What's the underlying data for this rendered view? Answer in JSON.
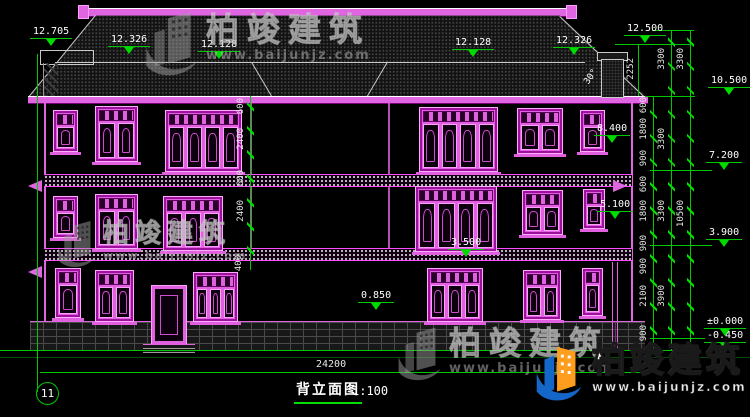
{
  "drawing": {
    "axis_bubble": "11",
    "title": "背立面图",
    "scale": "1:100",
    "total_width_dim": "24200",
    "roof_angle": "30°",
    "chimney_height_dim": "2252"
  },
  "watermark": {
    "brand": "柏竣建筑",
    "url": "www.baijunjz.com"
  },
  "elevation_markers": [
    "12.705",
    "12.326",
    "12.128",
    "12.128",
    "12.326",
    "12.500",
    "10.500",
    "8.400",
    "7.200",
    "5.100",
    "3.900",
    "3.500",
    "0.850",
    "±0.000",
    "-0.450"
  ],
  "dims": {
    "left_inner": [
      "600",
      "2400",
      "600",
      "2400",
      "400"
    ],
    "right_inner": [
      "600",
      "1800",
      "900",
      "600",
      "1800",
      "900",
      "900",
      "2100",
      "900"
    ],
    "right_storey": [
      "3300",
      "3300",
      "3300",
      "3900"
    ],
    "right_overall": [
      "3300",
      "10500"
    ]
  },
  "colors": {
    "line_green": "#00c800",
    "window_magenta": "#e060e0",
    "background": "#000000"
  }
}
